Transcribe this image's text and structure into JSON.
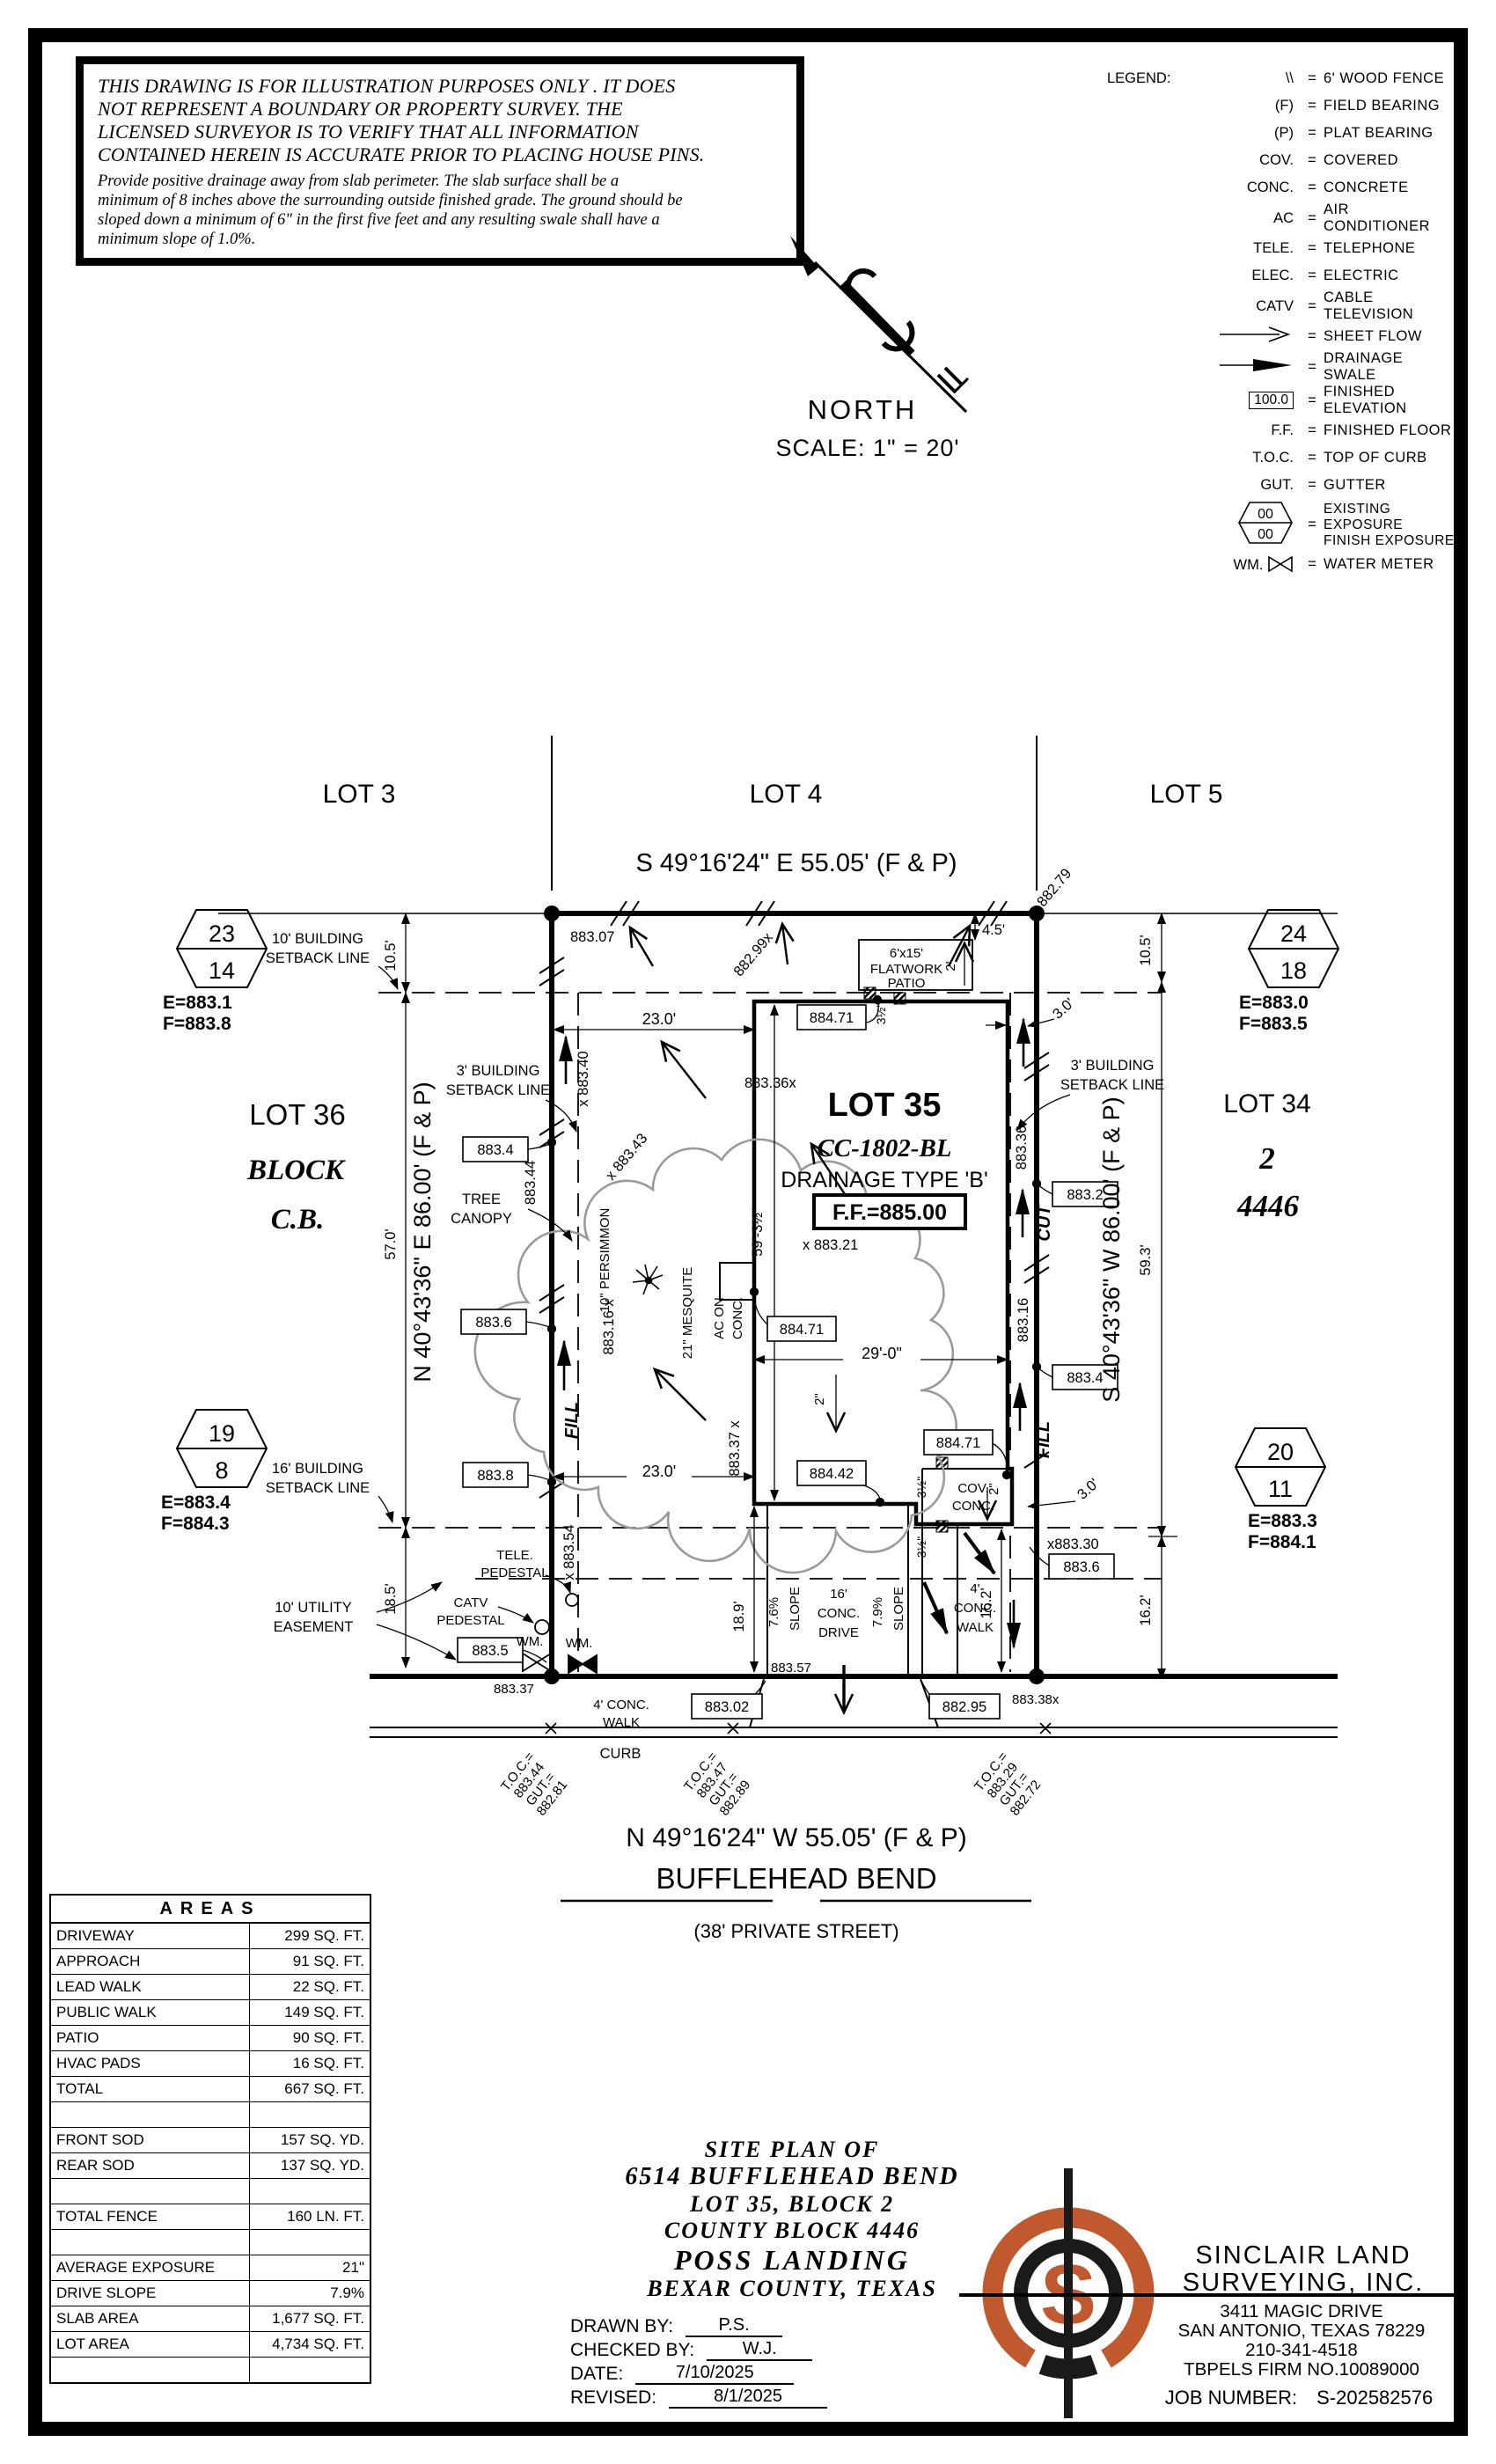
{
  "disclaimer": {
    "title_lines": [
      "THIS DRAWING IS FOR ILLUSTRATION PURPOSES ONLY . IT DOES",
      "NOT REPRESENT A BOUNDARY OR PROPERTY SURVEY. THE",
      "LICENSED SURVEYOR IS TO VERIFY THAT ALL INFORMATION",
      "CONTAINED HEREIN IS ACCURATE PRIOR TO PLACING HOUSE PINS."
    ],
    "body_lines": [
      "Provide positive drainage away from slab perimeter. The slab surface shall be a",
      "minimum of 8 inches above the surrounding outside finished grade. The ground should be",
      "sloped down a minimum of 6\" in the first five feet and any resulting swale shall have a",
      "minimum slope of 1.0%."
    ]
  },
  "north": {
    "label": "NORTH",
    "scale": "SCALE: 1\" = 20'"
  },
  "legend": {
    "title": "LEGEND:",
    "items": [
      {
        "sym": "\\\\",
        "text": "6' WOOD FENCE"
      },
      {
        "sym": "(F)",
        "text": "FIELD BEARING"
      },
      {
        "sym": "(P)",
        "text": "PLAT BEARING"
      },
      {
        "sym": "COV.",
        "text": "COVERED"
      },
      {
        "sym": "CONC.",
        "text": "CONCRETE"
      },
      {
        "sym": "AC",
        "text": "AIR CONDITIONER"
      },
      {
        "sym": "TELE.",
        "text": "TELEPHONE"
      },
      {
        "sym": "ELEC.",
        "text": "ELECTRIC"
      },
      {
        "sym": "CATV",
        "text": "CABLE TELEVISION"
      },
      {
        "sym": "",
        "text": "SHEET FLOW"
      },
      {
        "sym": "",
        "text": "DRAINAGE SWALE"
      },
      {
        "sym": "100.0",
        "text": "FINISHED ELEVATION"
      },
      {
        "sym": "F.F.",
        "text": "FINISHED FLOOR"
      },
      {
        "sym": "T.O.C.",
        "text": "TOP OF CURB"
      },
      {
        "sym": "GUT.",
        "text": "GUTTER"
      },
      {
        "sym_top": "00",
        "sym_bottom": "00",
        "text": "EXISTING EXPOSURE",
        "text2": "FINISH EXPOSURE"
      },
      {
        "sym": "WM.",
        "text": "WATER METER"
      }
    ]
  },
  "plan": {
    "lots_top": [
      "LOT 3",
      "LOT 4",
      "LOT 5"
    ],
    "bearing_top": "S 49°16'24\" E 55.05' (F & P)",
    "bearing_left": "N 40°43'36\" E 86.00' (F & P)",
    "bearing_right": "S 40°43'36\" W 86.00' (F & P)",
    "street": {
      "bearing": "N 49°16'24\" W 55.05' (F & P)",
      "name": "BUFFLEHEAD BEND",
      "sub": "(38' PRIVATE STREET)",
      "curb": "CURB",
      "walk": [
        "4' CONC.",
        "WALK"
      ]
    },
    "lot36": {
      "lot": "LOT 36",
      "block": "BLOCK",
      "cb": "C.B."
    },
    "lot34": {
      "lot": "LOT 34",
      "block": "2",
      "cb": "4446"
    },
    "house": {
      "lot": "LOT 35",
      "model": "CC-1802-BL",
      "drainage": "DRAINAGE TYPE 'B'",
      "ff": "F.F.=885.00",
      "cov": [
        "COV.",
        "CONC."
      ],
      "ac": [
        "AC ON",
        "CONC."
      ],
      "flatwork": [
        "6'x15'",
        "FLATWORK",
        "PATIO"
      ]
    },
    "labels": {
      "setback10": [
        "10' BUILDING",
        "SETBACK LINE"
      ],
      "setback16": [
        "16' BUILDING",
        "SETBACK LINE"
      ],
      "setback3": [
        "3' BUILDING",
        "SETBACK LINE"
      ],
      "utility": [
        "10' UTILITY",
        "EASEMENT"
      ],
      "tree": [
        "TREE",
        "CANOPY"
      ],
      "persimmon": "10\" PERSIMMON",
      "mesquite": "21\" MESQUITE",
      "tele": [
        "TELE.",
        "PEDESTAL"
      ],
      "catv": [
        "CATV",
        "PEDESTAL"
      ],
      "wm": "WM.",
      "drive": [
        "16'",
        "CONC.",
        "DRIVE"
      ],
      "walk": [
        "4'",
        "CONC.",
        "WALK"
      ],
      "slope1": "7.6%",
      "slope2": "7.9%",
      "slope_word": "SLOPE",
      "fill": "FILL",
      "cut": "CUT"
    },
    "dims": {
      "a10_5": "10.5'",
      "b10_5": "10.5'",
      "d57": "57.0'",
      "d18_5": "18.5'",
      "d59_3": "59.3'",
      "r16_2": "16.2'",
      "i16_2": "16.2'",
      "d18_9": "18.9'",
      "t23": "23.0'",
      "b23": "23.0'",
      "d29": "29'-0\"",
      "h59": "59'-3½\"",
      "d4_5": "4.5'",
      "p2": "2'",
      "a2": "2\"",
      "c2": "2\"",
      "t3": "3.0'",
      "b3": "3.0'",
      "h35": "3½\""
    },
    "hex": [
      {
        "top": "23",
        "bot": "14",
        "e": "E=883.1",
        "f": "F=883.8"
      },
      {
        "top": "19",
        "bot": "8",
        "e": "E=883.4",
        "f": "F=884.3"
      },
      {
        "top": "24",
        "bot": "18",
        "e": "E=883.0",
        "f": "F=883.5"
      },
      {
        "top": "20",
        "bot": "11",
        "e": "E=883.3",
        "f": "F=884.1"
      }
    ],
    "boxes": {
      "l1": "883.4",
      "l2": "883.6",
      "l3": "883.8",
      "l4": "883.5",
      "r1": "883.2",
      "r2": "883.4",
      "r3": "883.6",
      "s1": "883.02",
      "s2": "882.95",
      "h1": "884.71",
      "h2": "884.71",
      "h3": "884.71",
      "h4": "884.42"
    },
    "spots": {
      "t1": "883.07",
      "t2": "882.79",
      "t3": "882.99x",
      "t4": "x 883.40",
      "t5": "883.36x",
      "t6": "x 883.43",
      "t7": "x 883.21",
      "l8": "883.16 x",
      "l44": "883.44",
      "l54": "x 883.54",
      "m37": "883.37 x",
      "r36": "883.36",
      "r16": "883.16",
      "r30": "x883.30",
      "s37": "883.37",
      "s57": "883.57",
      "s38": "883.38x"
    },
    "toc": [
      [
        "T.O.C.=",
        "883.44",
        "GUT.=",
        "882.81"
      ],
      [
        "T.O.C.=",
        "883.47",
        "GUT.=",
        "882.89"
      ],
      [
        "T.O.C.=",
        "883.29",
        "GUT.=",
        "882.72"
      ]
    ]
  },
  "areas": {
    "title": "AREAS",
    "rows": [
      {
        "label": "DRIVEWAY",
        "value": "299 SQ. FT."
      },
      {
        "label": "APPROACH",
        "value": "91 SQ. FT."
      },
      {
        "label": "LEAD WALK",
        "value": "22 SQ. FT."
      },
      {
        "label": "PUBLIC WALK",
        "value": "149 SQ. FT."
      },
      {
        "label": "PATIO",
        "value": "90 SQ. FT."
      },
      {
        "label": "HVAC PADS",
        "value": "16 SQ. FT."
      },
      {
        "label": "TOTAL",
        "value": "667 SQ. FT."
      },
      {
        "label": "",
        "value": ""
      },
      {
        "label": "FRONT SOD",
        "value": "157 SQ. YD."
      },
      {
        "label": "REAR SOD",
        "value": "137 SQ. YD."
      },
      {
        "label": "",
        "value": ""
      },
      {
        "label": "TOTAL FENCE",
        "value": "160 LN. FT."
      },
      {
        "label": "",
        "value": ""
      },
      {
        "label": "AVERAGE EXPOSURE",
        "value": "21\""
      },
      {
        "label": "DRIVE SLOPE",
        "value": "7.9%"
      },
      {
        "label": "SLAB AREA",
        "value": "1,677 SQ. FT."
      },
      {
        "label": "LOT AREA",
        "value": "4,734 SQ. FT."
      },
      {
        "label": "",
        "value": ""
      }
    ]
  },
  "title_block": {
    "lines": [
      "SITE PLAN OF",
      "6514 BUFFLEHEAD BEND",
      "LOT 35, BLOCK 2",
      "COUNTY BLOCK 4446",
      "POSS LANDING",
      "BEXAR COUNTY, TEXAS"
    ],
    "drawn_label": "DRAWN BY:",
    "drawn": "P.S.",
    "checked_label": "CHECKED BY:",
    "checked": "W.J.",
    "date_label": "DATE:",
    "date": "7/10/2025",
    "revised_label": "REVISED:",
    "revised": "8/1/2025"
  },
  "firm": {
    "name1": "SINCLAIR LAND",
    "name2": "SURVEYING, INC.",
    "addr1": "3411 MAGIC DRIVE",
    "addr2": "SAN ANTONIO, TEXAS 78229",
    "phone": "210-341-4518",
    "tbpels": "TBPELS FIRM NO.10089000",
    "job_label": "JOB NUMBER:",
    "job": "S-202582576",
    "logo_letter": "S"
  },
  "colors": {
    "accent": "#c05a2e",
    "tree_canopy": "#9a9a9a"
  }
}
